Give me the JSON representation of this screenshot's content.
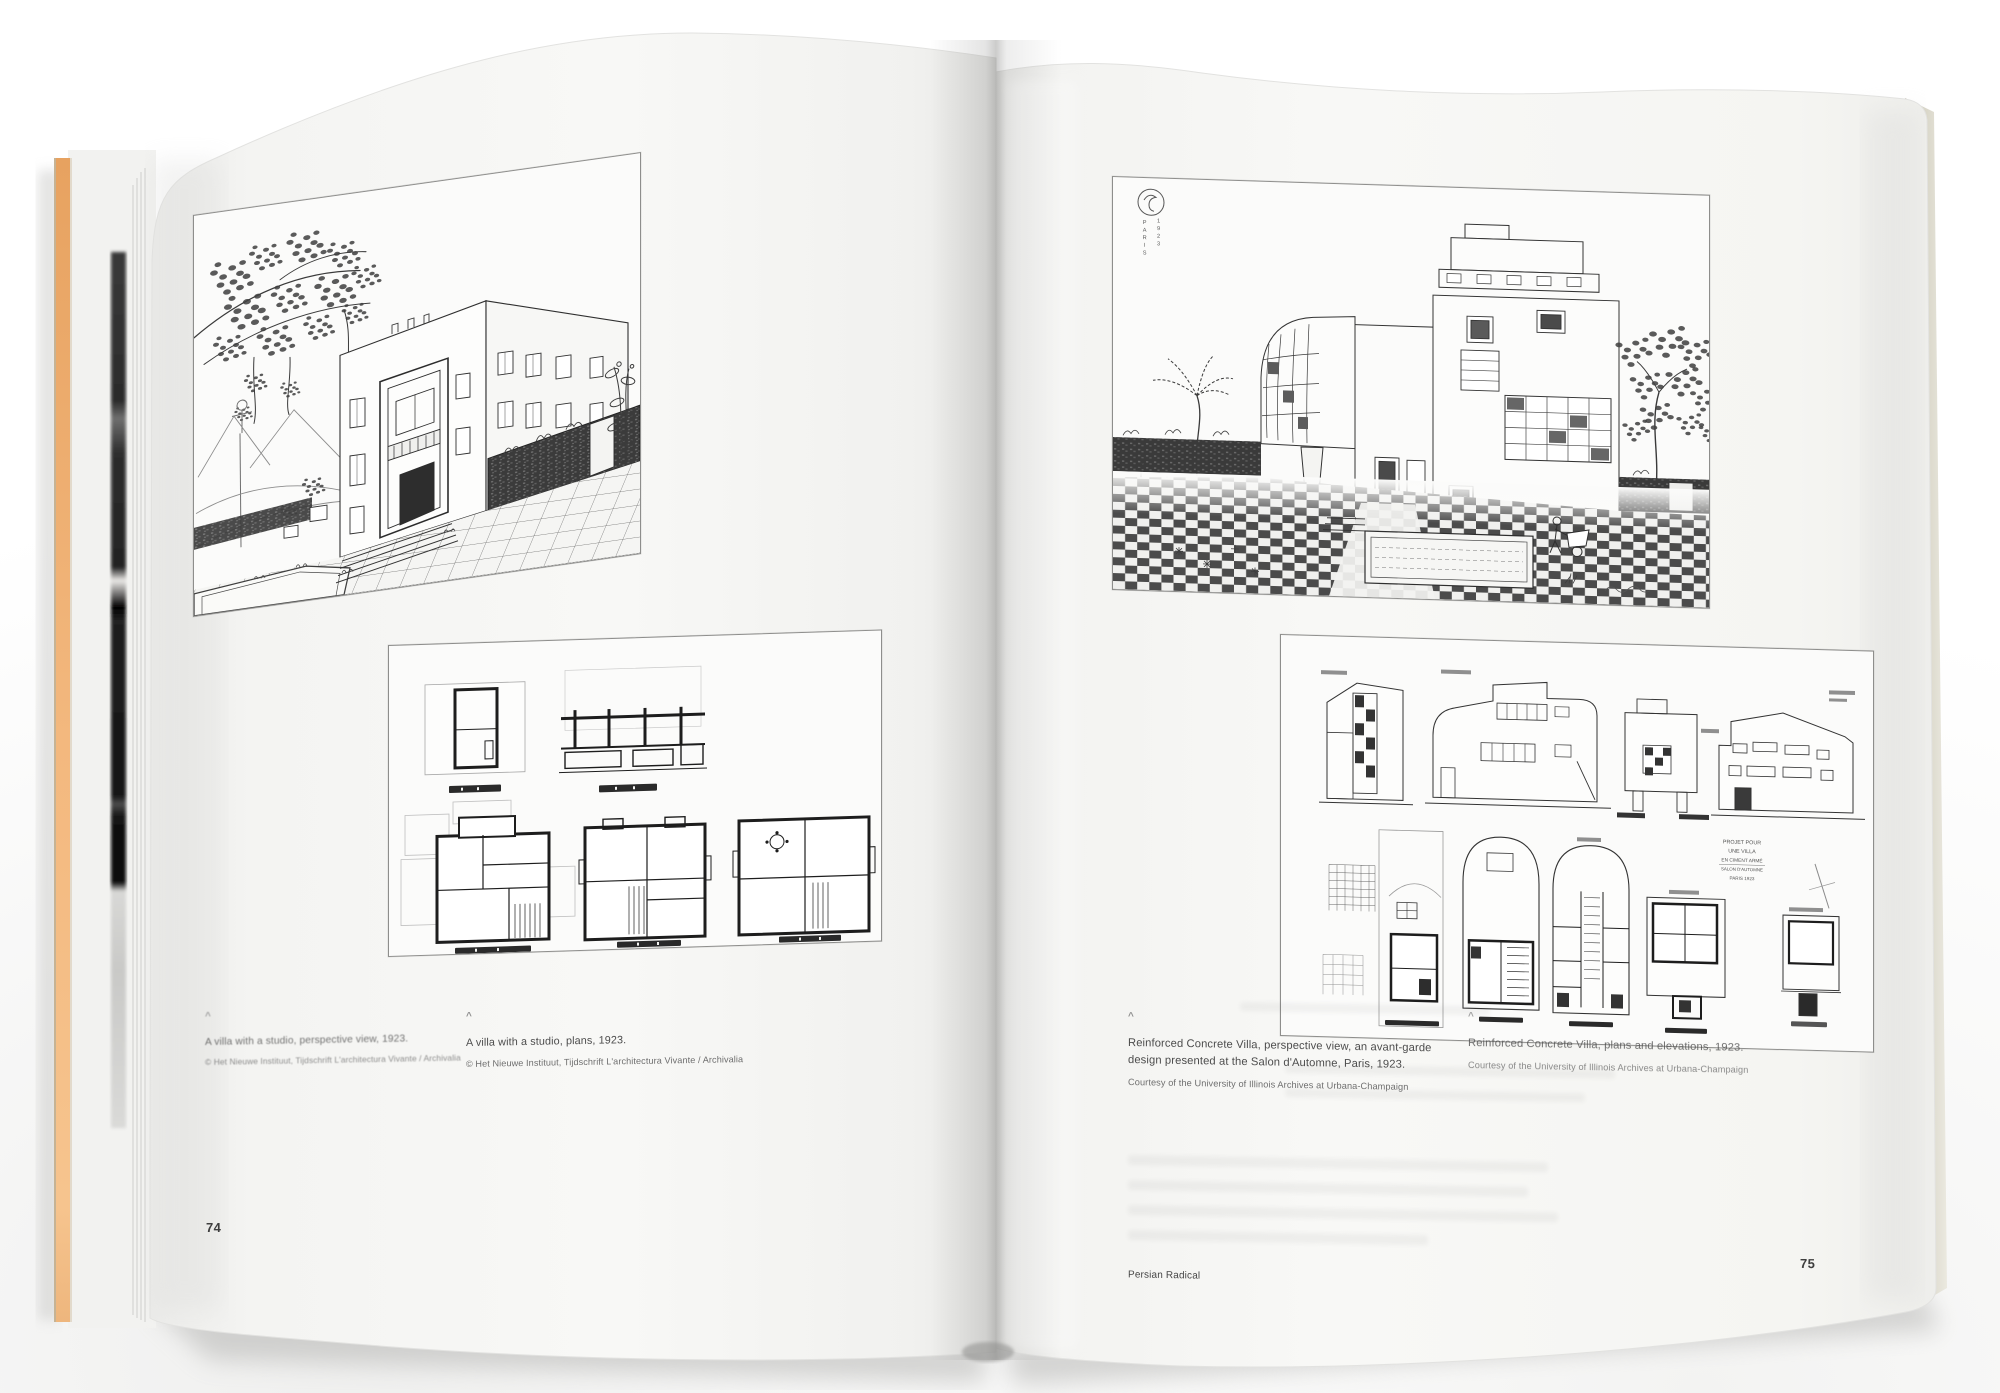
{
  "book": {
    "title_footer": "Persian Radical",
    "left_page": {
      "page_number": "74",
      "caret": "^",
      "figures": [
        {
          "name": "villa-with-studio-perspective",
          "caption": "A villa with a studio, perspective view, 1923.",
          "credit": "© Het Nieuwe Instituut, Tijdschrift L'architectura Vivante / Archivalia"
        },
        {
          "name": "villa-with-studio-plans",
          "caption": "A villa with a studio, plans, 1923.",
          "credit": "© Het Nieuwe Instituut, Tijdschrift L'architectura Vivante / Archivalia"
        }
      ]
    },
    "right_page": {
      "page_number": "75",
      "caret": "^",
      "stamp": {
        "column_left": "PARIS",
        "column_right": "1923"
      },
      "figures": [
        {
          "name": "reinforced-concrete-villa-perspective",
          "caption": "Reinforced Concrete Villa, perspective view, an avant-garde design presented at the Salon d'Automne, Paris, 1923.",
          "credit": "Courtesy of the University of Illinois Archives at Urbana-Champaign"
        },
        {
          "name": "reinforced-concrete-villa-plans",
          "caption": "Reinforced Concrete Villa, plans and elevations, 1923.",
          "credit": "Courtesy of the University of Illinois Archives at Urbana-Champaign"
        }
      ],
      "plan_note": [
        "PROJET POUR",
        "UNE VILLA",
        "EN CIMENT ARMÉ",
        "SALON D'AUTOMNE",
        "PARIS 1923"
      ]
    },
    "colors": {
      "edge_orange": "#f0ad6e",
      "paper": "#f7f7f5",
      "ink": "#333333"
    }
  }
}
